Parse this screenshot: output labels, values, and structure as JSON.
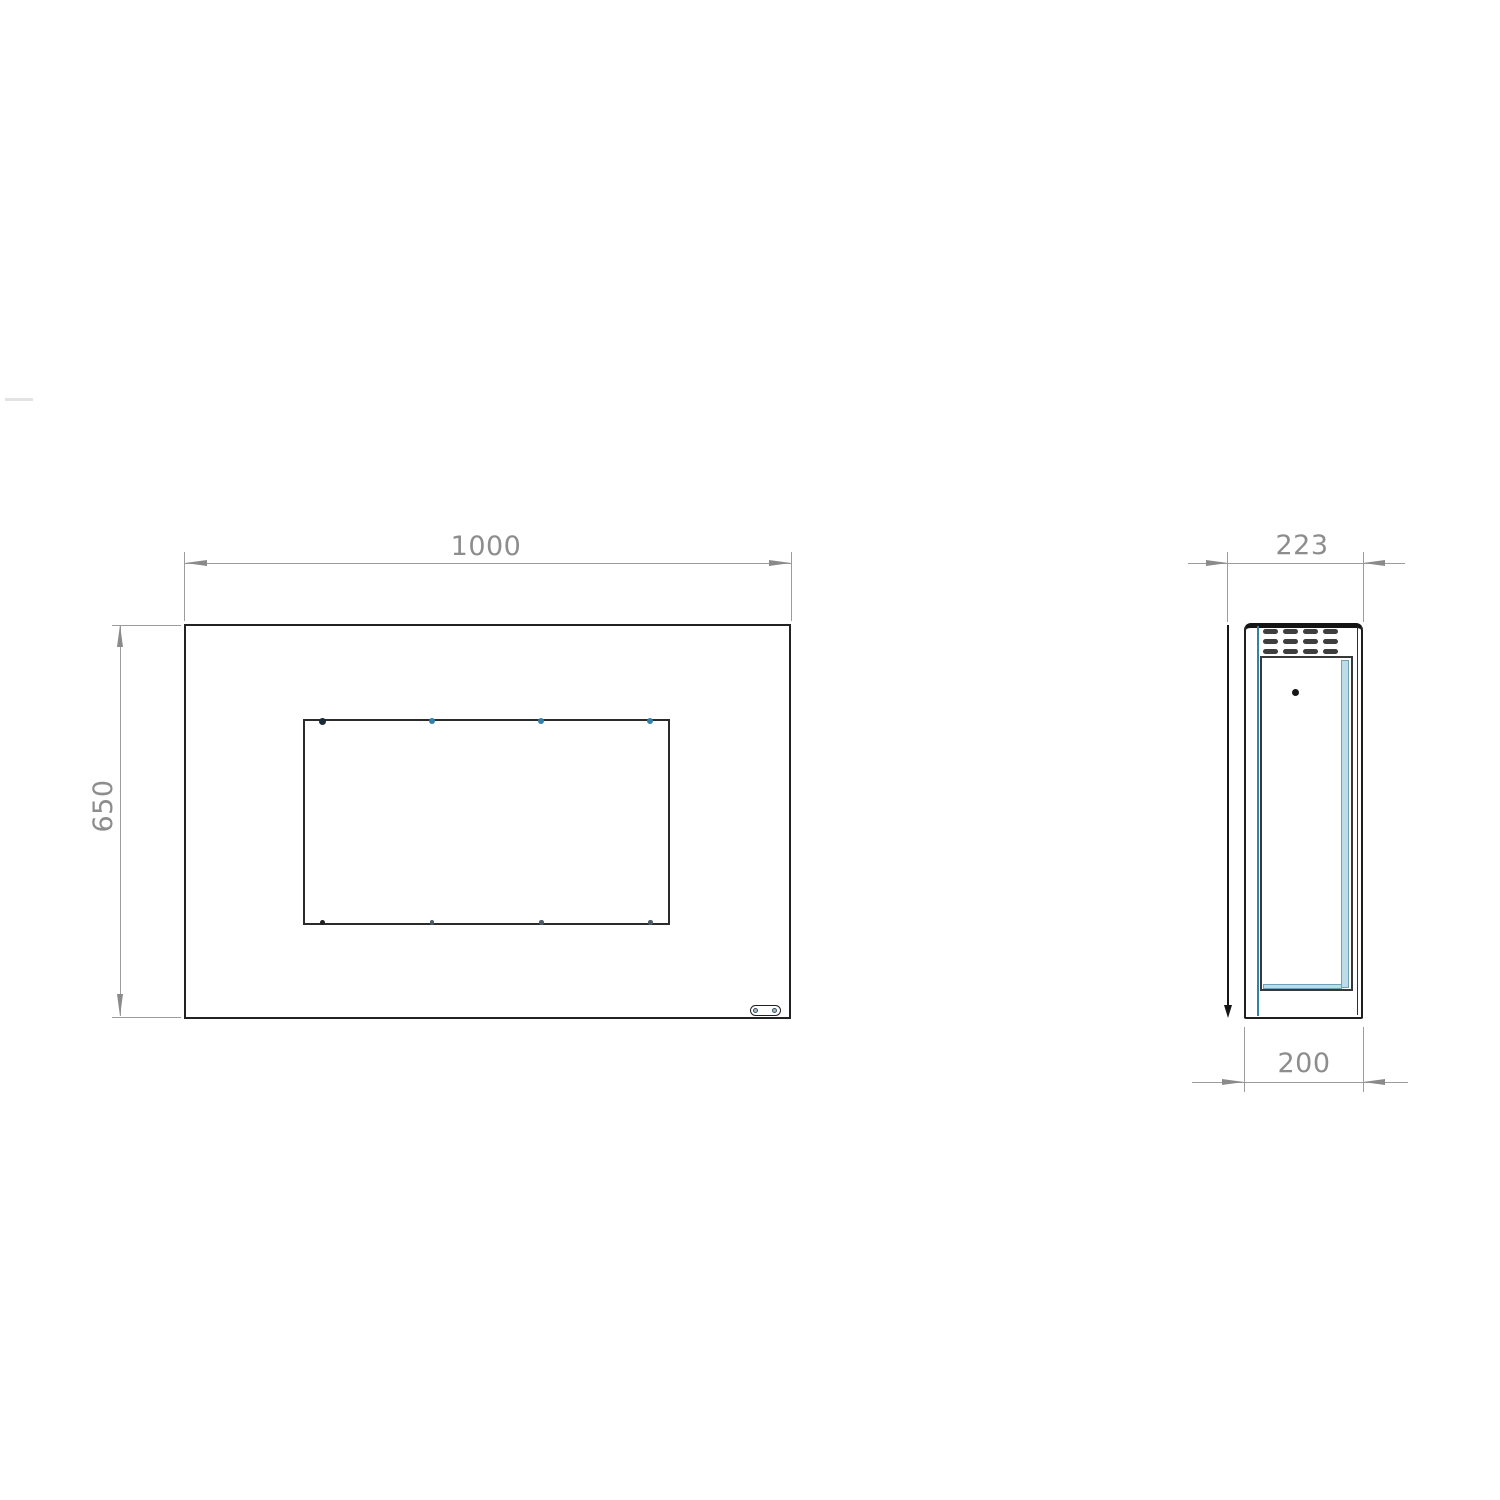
{
  "drawing": {
    "front_view": {
      "width_label": "1000",
      "height_label": "650"
    },
    "side_view": {
      "depth_label": "223",
      "body_depth_label": "200"
    }
  },
  "colors": {
    "object_line": "#1f1f1f",
    "dimension_gray": "#8d8d8d",
    "accent_teal": "#3380ab",
    "glass_light_blue": "#bcdde7",
    "background": "#ffffff"
  }
}
